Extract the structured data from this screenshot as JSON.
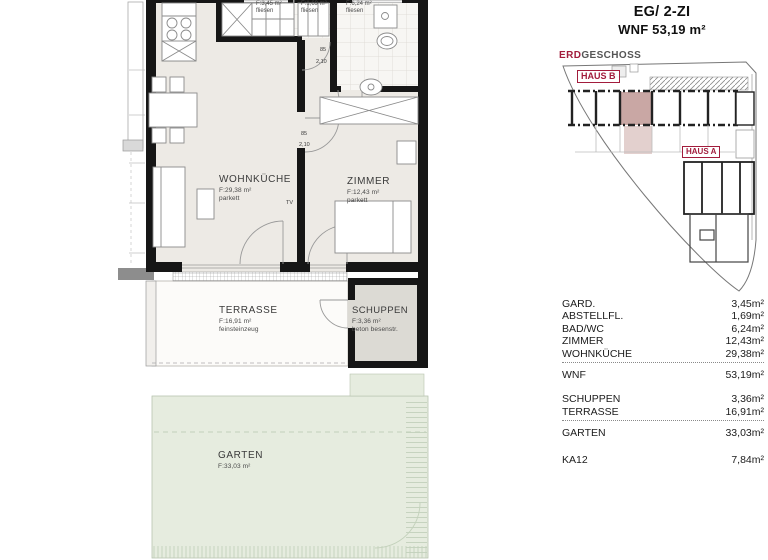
{
  "header": {
    "line1": "EG/ 2-ZI",
    "line2": "WNF 53,19 m²"
  },
  "site_plan": {
    "level_label_accent": "ERD",
    "level_label_rest": "GESCHOSS",
    "haus_b_label": "HAUS B",
    "haus_a_label": "HAUS A",
    "highlight_color": "#c9a7a4",
    "accent_color": "#a21c3c"
  },
  "floor_plan": {
    "wohnkueche": {
      "name": "WOHNKÜCHE",
      "area": "F:29,38 m²",
      "finish": "parkett"
    },
    "zimmer": {
      "name": "ZIMMER",
      "area": "F:12,43 m²",
      "finish": "parkett"
    },
    "terrasse": {
      "name": "TERRASSE",
      "area": "F:16,91 m²",
      "finish": "feinsteinzeug"
    },
    "schuppen": {
      "name": "SCHUPPEN",
      "area": "F:3,36 m²",
      "finish": "beton besenstr."
    },
    "garten": {
      "name": "GARTEN",
      "area": "F:33,03 m²"
    },
    "garderobe": {
      "area": "F:3,45 m²",
      "finish": "fliesen"
    },
    "abstellraum": {
      "area": "F:1,69 m²",
      "finish": "fliesen"
    },
    "bad_wc": {
      "area": "F:6,24 m²",
      "finish": "fliesen"
    },
    "door_width": "85",
    "door_height": "2,10",
    "tv_label": "TV"
  },
  "area_table": {
    "rows": [
      {
        "label": "GARD.",
        "value": "3,45m²"
      },
      {
        "label": "ABSTELLFL.",
        "value": "1,69m²"
      },
      {
        "label": "BAD/WC",
        "value": "6,24m²"
      },
      {
        "label": "ZIMMER",
        "value": "12,43m²"
      },
      {
        "label": "WOHNKÜCHE",
        "value": "29,38m²"
      },
      {
        "label": "WNF",
        "value": "53,19m²"
      },
      {
        "label": "SCHUPPEN",
        "value": "3,36m²"
      },
      {
        "label": "TERRASSE",
        "value": "16,91m²"
      },
      {
        "label": "GARTEN",
        "value": "33,03m²"
      },
      {
        "label": "KA12",
        "value": "7,84m²"
      }
    ]
  }
}
